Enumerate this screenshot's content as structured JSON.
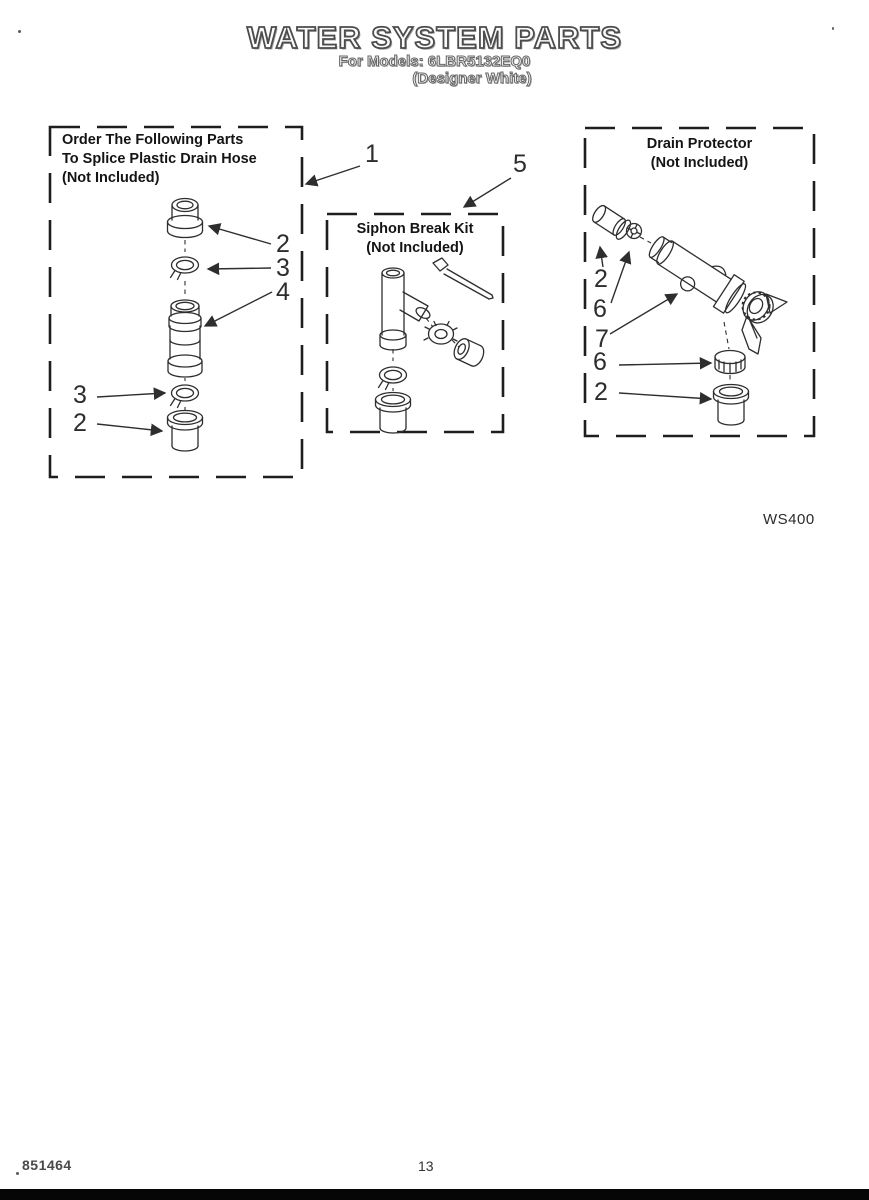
{
  "header": {
    "title": "WATER SYSTEM PARTS",
    "models_line": "For Models: 6LBR5132EQ0",
    "color_line": "(Designer White)"
  },
  "boxes": {
    "splice_kit": {
      "title_line1": "Order The Following Parts",
      "title_line2": "To Splice Plastic Drain Hose",
      "title_line3": "(Not Included)"
    },
    "siphon_break": {
      "title_line1": "Siphon Break Kit",
      "title_line2": "(Not Included)"
    },
    "drain_protector": {
      "title_line1": "Drain Protector",
      "title_line2": "(Not Included)"
    }
  },
  "callouts": {
    "item1": "1",
    "item5": "5",
    "splice_top_coupler": "2",
    "splice_top_clamp": "3",
    "splice_connector": "4",
    "splice_bottom_clamp": "3",
    "splice_bottom_coupler": "2",
    "drain_top_coupler": "2",
    "drain_top_clamp": "6",
    "drain_body": "7",
    "drain_bottom_clamp": "6",
    "drain_bottom_coupler": "2"
  },
  "annotations": {
    "diagram_code": "WS400"
  },
  "footer": {
    "document_number": "851464",
    "page_number": "13"
  },
  "colors": {
    "ink": "#2e2e2e",
    "paper": "#ffffff"
  }
}
